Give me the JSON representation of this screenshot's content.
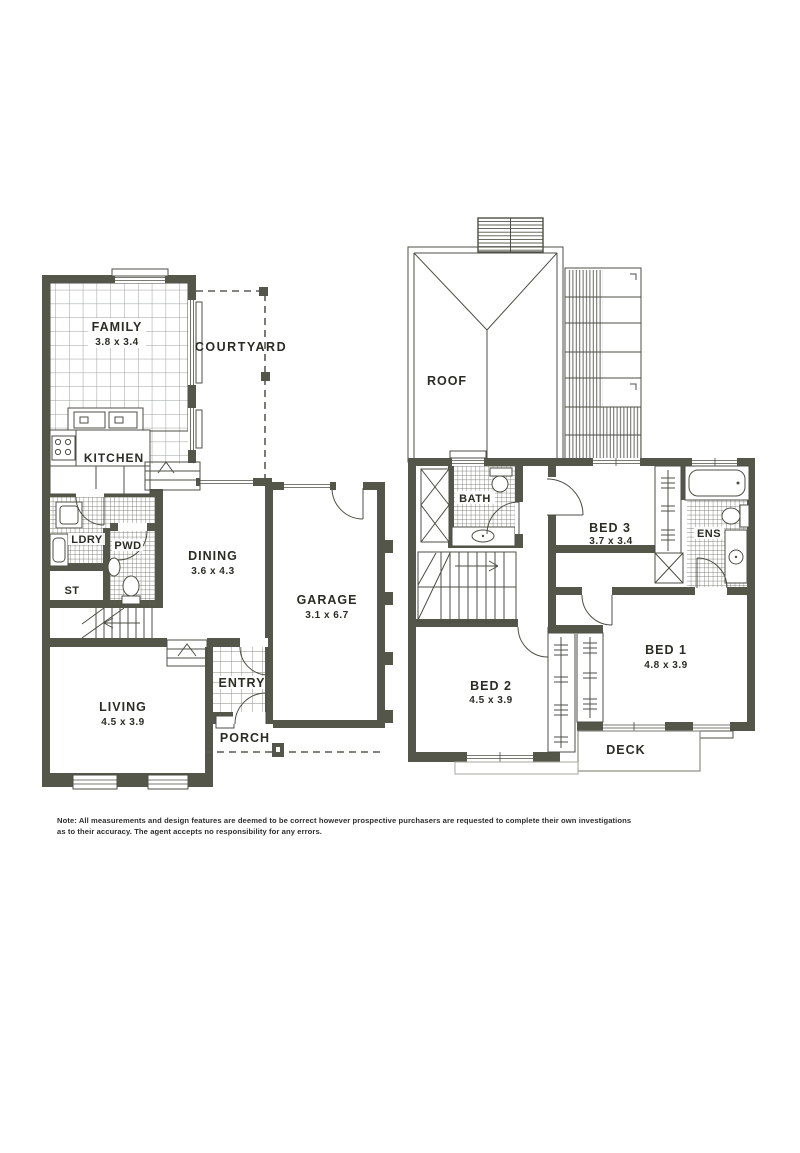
{
  "document": {
    "type": "real-estate floor plan, two storeys"
  },
  "colors": {
    "wall": "#54564a",
    "line": "#4d4f44",
    "tile_grid": "#9aa39b",
    "hatch": "#5f6156",
    "text": "#2b2d24",
    "paper": "#ffffff"
  },
  "ground_floor": {
    "rooms": {
      "family": {
        "name": "FAMILY",
        "dims": "3.8 x 3.4"
      },
      "courtyard": {
        "name": "COURTYARD",
        "dims": ""
      },
      "kitchen": {
        "name": "KITCHEN",
        "dims": ""
      },
      "ldry": {
        "name": "LDRY",
        "dims": ""
      },
      "pwd": {
        "name": "PWD",
        "dims": ""
      },
      "st": {
        "name": "ST",
        "dims": ""
      },
      "dining": {
        "name": "DINING",
        "dims": "3.6 x 4.3"
      },
      "garage": {
        "name": "GARAGE",
        "dims": "3.1 x 6.7"
      },
      "entry": {
        "name": "ENTRY",
        "dims": ""
      },
      "porch": {
        "name": "PORCH",
        "dims": ""
      },
      "living": {
        "name": "LIVING",
        "dims": "4.5 x 3.9"
      }
    }
  },
  "upper_floor": {
    "rooms": {
      "roof": {
        "name": "ROOF",
        "dims": ""
      },
      "bath": {
        "name": "BATH",
        "dims": ""
      },
      "bed3": {
        "name": "BED 3",
        "dims": "3.7 x 3.4"
      },
      "ens": {
        "name": "ENS",
        "dims": ""
      },
      "bed1": {
        "name": "BED 1",
        "dims": "4.8 x 3.9"
      },
      "bed2": {
        "name": "BED 2",
        "dims": "4.5 x 3.9"
      },
      "deck": {
        "name": "DECK",
        "dims": ""
      }
    }
  },
  "note": {
    "text": "Note: All measurements and design features are deemed to be correct however prospective purchasers are requested to complete their own investigations as to their accuracy. The agent accepts no responsibility for any errors."
  }
}
